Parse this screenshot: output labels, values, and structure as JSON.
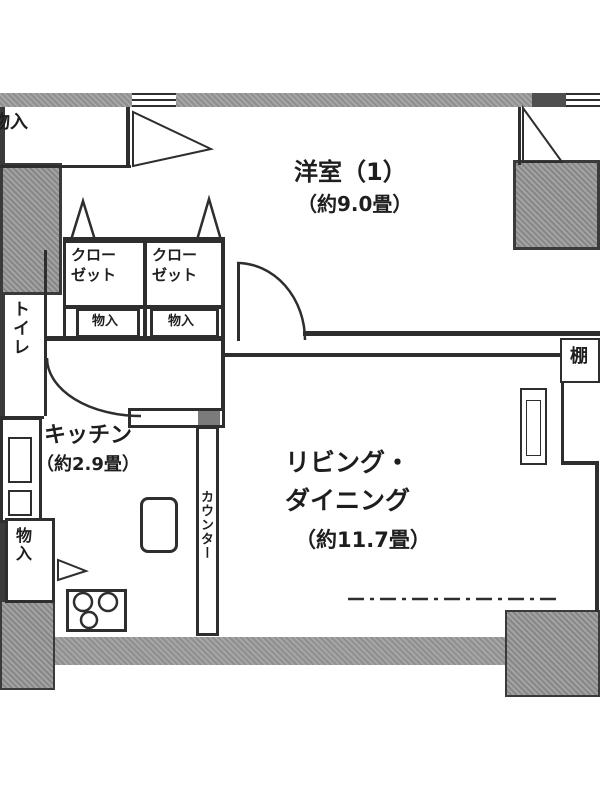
{
  "plan": {
    "type": "apartment-floor-plan",
    "colors": {
      "wall_gray": "#9a9a9a",
      "line": "#2e2e2e",
      "background": "#ffffff"
    },
    "rooms": {
      "bedroom": {
        "name": "洋室（1）",
        "size": "（約9.0畳）"
      },
      "living_dining": {
        "line1": "リビング・",
        "line2": "ダイニング",
        "size": "（約11.7畳）"
      },
      "kitchen": {
        "name": "キッチン",
        "size": "（約2.9畳）"
      },
      "toilet": {
        "name": "トイレ"
      },
      "closet1": {
        "line1": "クロー",
        "line2": "ゼット"
      },
      "closet2": {
        "line1": "クロー",
        "line2": "ゼット"
      }
    },
    "storage": {
      "top_left": {
        "name": "物入"
      },
      "under_closet1": {
        "name": "物入"
      },
      "under_closet2": {
        "name": "物入"
      },
      "bottom_left": {
        "name": "物入"
      }
    },
    "fixtures": {
      "counter": {
        "name": "カウンター"
      },
      "shelf": {
        "name": "棚"
      }
    }
  }
}
